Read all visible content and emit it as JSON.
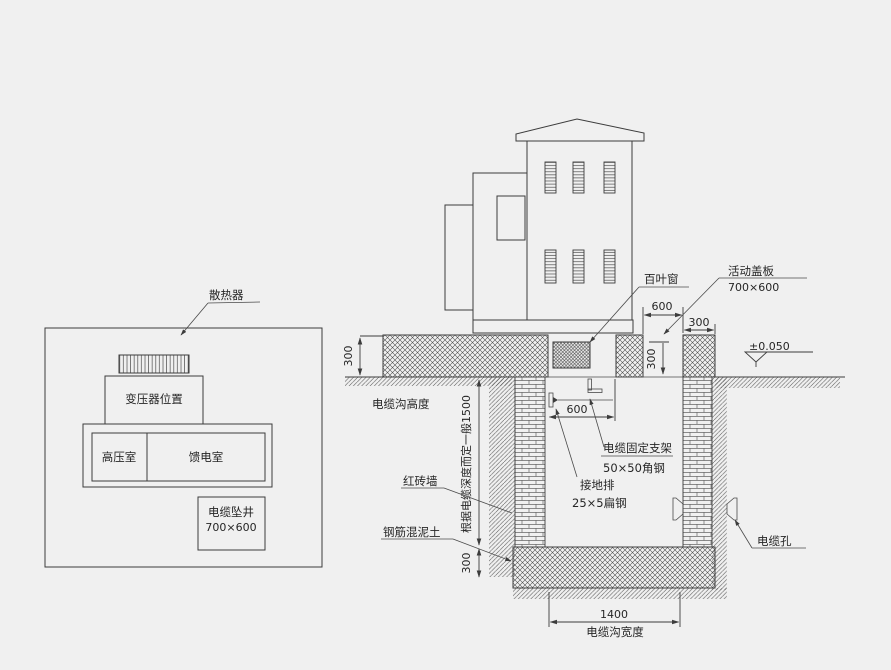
{
  "colors": {
    "background": "#f0f0f0",
    "line": "#3c3c3c",
    "text": "#262626"
  },
  "plan": {
    "radiator": "散热器",
    "transformer": "变压器位置",
    "hv_room": "高压室",
    "feeder_room": "馈电室",
    "shaft": "电缆坠井",
    "shaft_size": "700×600"
  },
  "section": {
    "louver": "百叶窗",
    "cover": "活动盖板",
    "cover_size": "700×600",
    "level": "±0.050",
    "trench_height": "电缆沟高度",
    "depth_note": "根据电缆深度而定一般1500",
    "brick_wall": "红砖墙",
    "concrete": "钢筋混泥土",
    "bracket": "电缆固定支架",
    "bracket_spec": "50×50角钢",
    "ground_bar": "接地排",
    "ground_bar_spec": "25×5扁钢",
    "cable_hole": "电缆孔",
    "trench_width": "电缆沟宽度",
    "dim_300_left": "300",
    "dim_600_top": "600",
    "dim_300_top": "300",
    "dim_300_opening": "300",
    "dim_600_bracket": "600",
    "dim_300_bottom": "300",
    "dim_1400": "1400"
  }
}
